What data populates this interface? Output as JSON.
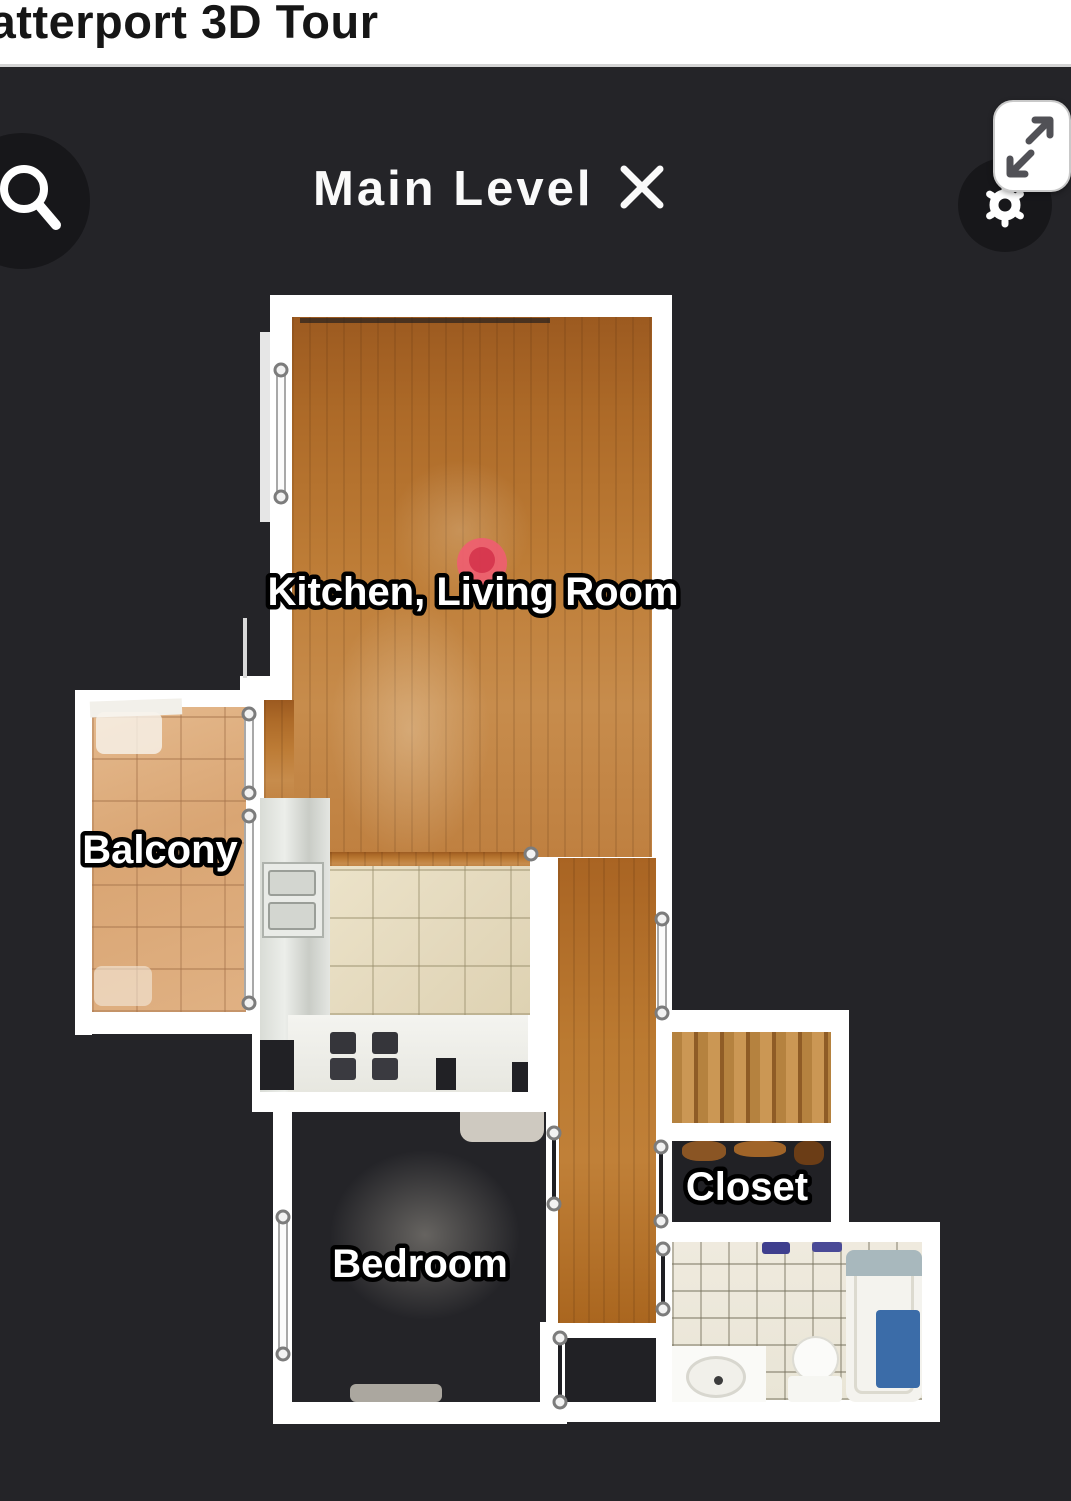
{
  "header": {
    "title": "Matterport 3D Tour"
  },
  "toolbar": {
    "level_name": "Main Level"
  },
  "rooms": {
    "kitchen_living": "Kitchen, Living Room",
    "balcony": "Balcony",
    "bedroom": "Bedroom",
    "closet": "Closet"
  },
  "icons": {
    "search": "magnifying-glass",
    "close": "x-cross",
    "settings": "gear",
    "expand": "diagonal-resize-arrows"
  },
  "colors": {
    "background": "#242428",
    "header_bg": "#ffffff",
    "wall": "#ffffff",
    "marker_red": "#ef5f70",
    "marker_red_dark": "#d93350",
    "tub_mat_blue": "#3b6ca8"
  }
}
